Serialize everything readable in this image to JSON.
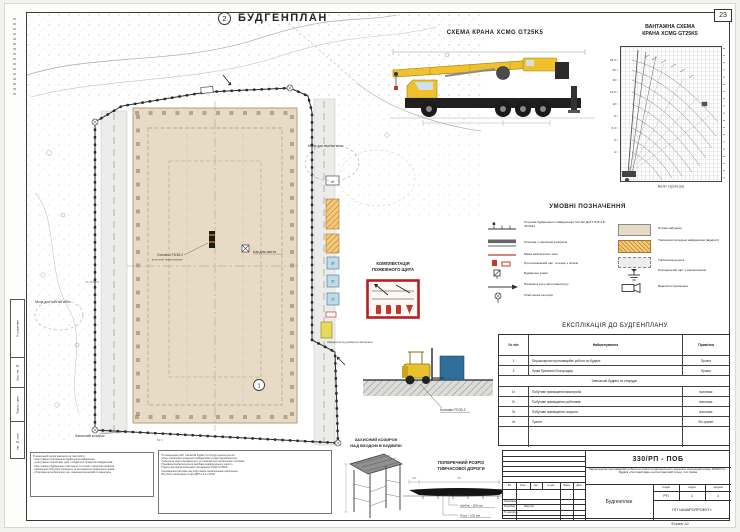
{
  "sheet": {
    "page_number": "23",
    "format_label": "Формат А2"
  },
  "plan": {
    "title": "БУДГЕНПЛАН",
    "callout_top": "2",
    "callout_building": "1",
    "labels": {
      "wheel_wash_left": "Місце для очистки коліс",
      "wheel_wash_right": "Місце для очистки коліс",
      "trash_bin": "Бак для сміття",
      "forklift_name": "Komatsu FD35-2",
      "forklift_type": "вилочний навантажувач",
      "canopy_ref": "Захисний козирок",
      "jack_pad": "майданчик під домкрати автокрана",
      "cabin_1": "1т",
      "cabin_2": "2т",
      "cabin_3": "3т",
      "cabin_4": "4т",
      "dim_bottom": "52.1",
      "dims_left": "4.5   13.5   7.8"
    }
  },
  "crane_scheme": {
    "title": "СХЕМА КРАНА  XCMG GT25K5"
  },
  "load_chart": {
    "title_line1": "ВАНТАЖНА СХЕМА",
    "title_line2": "КРАНА  XCMG GT25K5",
    "xlabel": "Виліт стріли (м)",
    "capacity_labels": [
      "25,0 т",
      "20 т",
      "16 т",
      "12,5 т",
      "10 т",
      "8 т",
      "6,3 т",
      "5 т",
      "4 т"
    ]
  },
  "chart_data": {
    "type": "line",
    "title": "ВАНТАЖНА СХЕМА КРАНА XCMG GT25K5",
    "xlabel": "Виліт стріли (м)",
    "ylabel": "Висота підйому (м)",
    "xlim": [
      0,
      40
    ],
    "ylim": [
      0,
      40
    ],
    "grid": true,
    "series": [
      {
        "name": "Вантажопідйомність по кривих, т",
        "values": [
          25,
          20,
          16,
          12.5,
          10,
          8,
          6.3,
          5,
          4
        ]
      }
    ],
    "note": "Криві вантажопідйомності крана XCMG GT25K5 залежно від вильоту стріли; ліворуч показана стріла у майже вертикальному положенні"
  },
  "legend": {
    "title": "УМОВНІ ПОЗНАЧЕННЯ",
    "left": [
      "Огорожа будівельного майданчика h=2,0м ДСТУ Б В.2.8-43:2011",
      "Огорожа з захисним козирком",
      "Межа небезпечної зони",
      "Протипожежний щит та ящик з піском",
      "Будівельні знаки",
      "Напрямок руху автотранспорту",
      "Освітлення на опорі"
    ],
    "right": [
      "Пляма забудови",
      "Тимчасові складські майданчики (відкриті)",
      "Тимчасова дорога",
      "Розподільчий щит з заземленням",
      "Відеоспостереження"
    ]
  },
  "explication": {
    "title": "ЕКСПЛІКАЦІЯ ДО БУДГЕНПЛАНУ",
    "col_num": "№ п/п",
    "col_name": "Найменування",
    "col_note": "Примітка",
    "rows": [
      {
        "num": "1",
        "name": "Першочергові протиаварійні роботи по  будівлі",
        "note": "Проект"
      },
      {
        "num": "2",
        "name": "Храм Пресвятої Богородиці",
        "note": "Проект"
      }
    ],
    "section": "Тимчасові будівлі та споруди",
    "rows2": [
      {
        "num": "1т",
        "name": "Побутове приміщення виконроба",
        "note": "вагончик"
      },
      {
        "num": "2т",
        "name": "Побутове приміщення робітників",
        "note": "вагончик"
      },
      {
        "num": "3т",
        "name": "Побутове приміщення охорони",
        "note": "вагончик"
      },
      {
        "num": "4т",
        "name": "Туалет",
        "note": "біо туалет"
      }
    ]
  },
  "fire_shield": {
    "title_line1": "КОМПЛЕКТАЦІЯ",
    "title_line2": "ПОЖЕЖНОГО ЩИТА"
  },
  "vignette": {
    "machine_label": "Komatsu FD30-2"
  },
  "canopy": {
    "title_line1": "ЗАХИСНИЙ КОЗИРОК",
    "title_line2": "НАД ВХОДОМ В БУДІВЛЮ"
  },
  "road_section": {
    "title_line1": "ПОПЕРЕЧНИЙ РОЗРІЗ",
    "title_line2": "ТИМЧАСОВОЇ ДОРОГИ",
    "layer1": "Щебінь - 200 мм",
    "layer2": "Пісок - 100 мм",
    "dim_left": "0,5",
    "dim_mid": "3,5",
    "dim_right": "0,5"
  },
  "notes": {
    "box1": [
      "В зазначений період виконуються такі роботи:",
      "- влаштування огородження будівельного майданчика;",
      "- улаштування тимчасових доріг та відкритих складських майданчиків;",
      "- влаштування будівельного освітлення та огорожі з захисним козирком;",
      "- розміщення побутових приміщень та встановлення будівельних знаків;",
      "- обгородження небезпечних зон, завезення механізмів та інвентарю."
    ],
    "box2": [
      "По закінченню робіт тимчасові будівлі та споруди демонтуються,",
      "місця тимчасових складських майданчиків та доріг відновлюються.",
      "Небезпечні зони огороджуються та позначаються сигнальними стрічками.",
      "Працівники забезпечуються засобами індивідуального захисту.",
      "Подачу матеріалів виконувати автокраном XCMG GT25K5.",
      "Переміщення вантажів над побутовими приміщеннями заборонено.",
      "Всі роботи виконувати згідно ДБН А.3.2-2-2009."
    ]
  },
  "title_block": {
    "code": "330/РП - ПОБ",
    "description": "Першочергові протиаварійні роботи на пам'ятці національного значення (охоронний номер 260067/1) – Будівлі «Гостиний двір» на Контрактовій площі, 4 м. Києва",
    "rev_headers": [
      "Зм.",
      "Кільк.",
      "Арк.",
      "№ док.",
      "Підпис",
      "Дата"
    ],
    "stage_headers": [
      "Стадія",
      "Аркуш",
      "Аркушів"
    ],
    "stage_values": [
      "РП",
      "1",
      "1"
    ],
    "roles": [
      {
        "role": "Перевірив",
        "name": ""
      },
      {
        "role": "Розробив",
        "name": "Закутній"
      },
      {
        "role": "Н. контроль",
        "name": ""
      }
    ],
    "doc_title": "Будгенплан",
    "org": "ПП «АМАРОПРОЕКТ»"
  },
  "margin": {
    "labels": [
      "Погодження",
      "Зам. інв. №",
      "Підпис і дата",
      "Інв. № ориг."
    ]
  }
}
